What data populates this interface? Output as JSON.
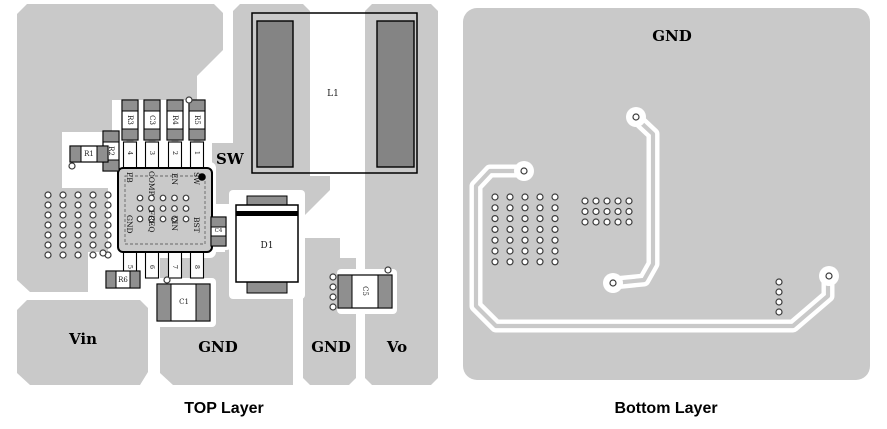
{
  "colors": {
    "pour": "#c9c9c9",
    "pad": "#8f8f8f",
    "lpad": "#848484",
    "viaring": "#3c3c3c"
  },
  "top_panel": {
    "title": "TOP Layer",
    "net_labels": {
      "sw": "SW",
      "vin": "Vin",
      "gnd1": "GND",
      "gnd2": "GND",
      "vo": "Vo"
    },
    "components": {
      "r1": "R1",
      "r2": "R2",
      "r3": "R3",
      "c3": "C3",
      "r4": "R4",
      "r5": "R5",
      "r6": "R6",
      "c1": "C1",
      "c4": "C4",
      "c5": "C5",
      "d1": "D1",
      "l1": "L1"
    },
    "ic": {
      "pin_labels_top": [
        "FB",
        "COMP",
        "EN",
        "SW"
      ],
      "pin_labels_bottom": [
        "GND",
        "FREQ",
        "VIN",
        "BST"
      ],
      "pin_numbers_top": [
        "4",
        "3",
        "2",
        "1"
      ],
      "pin_numbers_bottom": [
        "5",
        "6",
        "7",
        "8"
      ]
    }
  },
  "bottom_panel": {
    "title": "Bottom Layer",
    "net_labels": {
      "gnd": "GND"
    }
  },
  "vias": {
    "grids": [
      {
        "host": "g-top-array",
        "x0": 48,
        "y0": 195,
        "cols": 5,
        "rows": 7,
        "dx": 15,
        "dy": 10,
        "r": 3
      },
      {
        "host": "g-ic-vias",
        "x0": 140,
        "y0": 198,
        "cols": 5,
        "rows": 3,
        "dx": 11.5,
        "dy": 10.5,
        "r": 2.8
      },
      {
        "host": "g-c5-vias",
        "x0": 333,
        "y0": 277,
        "cols": 1,
        "rows": 4,
        "dx": 0,
        "dy": 10,
        "r": 3
      },
      {
        "host": "g-bot-array1",
        "x0": 495,
        "y0": 197,
        "cols": 5,
        "rows": 7,
        "dx": 15,
        "dy": 10.8,
        "r": 3
      },
      {
        "host": "g-bot-array2",
        "x0": 585,
        "y0": 201,
        "cols": 5,
        "rows": 3,
        "dx": 11,
        "dy": 10.5,
        "r": 3
      },
      {
        "host": "g-bot-column",
        "x0": 779,
        "y0": 282,
        "cols": 1,
        "rows": 4,
        "dx": 0,
        "dy": 10,
        "r": 3
      }
    ],
    "singles": [
      {
        "host": "g-top-singles",
        "x": 189,
        "y": 100
      },
      {
        "host": "g-top-singles",
        "x": 72,
        "y": 166
      },
      {
        "host": "g-top-singles",
        "x": 167,
        "y": 280
      },
      {
        "host": "g-top-singles",
        "x": 388,
        "y": 270
      },
      {
        "host": "g-top-singles",
        "x": 103,
        "y": 253
      },
      {
        "host": "g-bot-singles",
        "x": 636,
        "y": 117
      },
      {
        "host": "g-bot-singles",
        "x": 613,
        "y": 283
      },
      {
        "host": "g-bot-singles",
        "x": 524,
        "y": 171
      },
      {
        "host": "g-bot-singles",
        "x": 829,
        "y": 276
      }
    ]
  }
}
